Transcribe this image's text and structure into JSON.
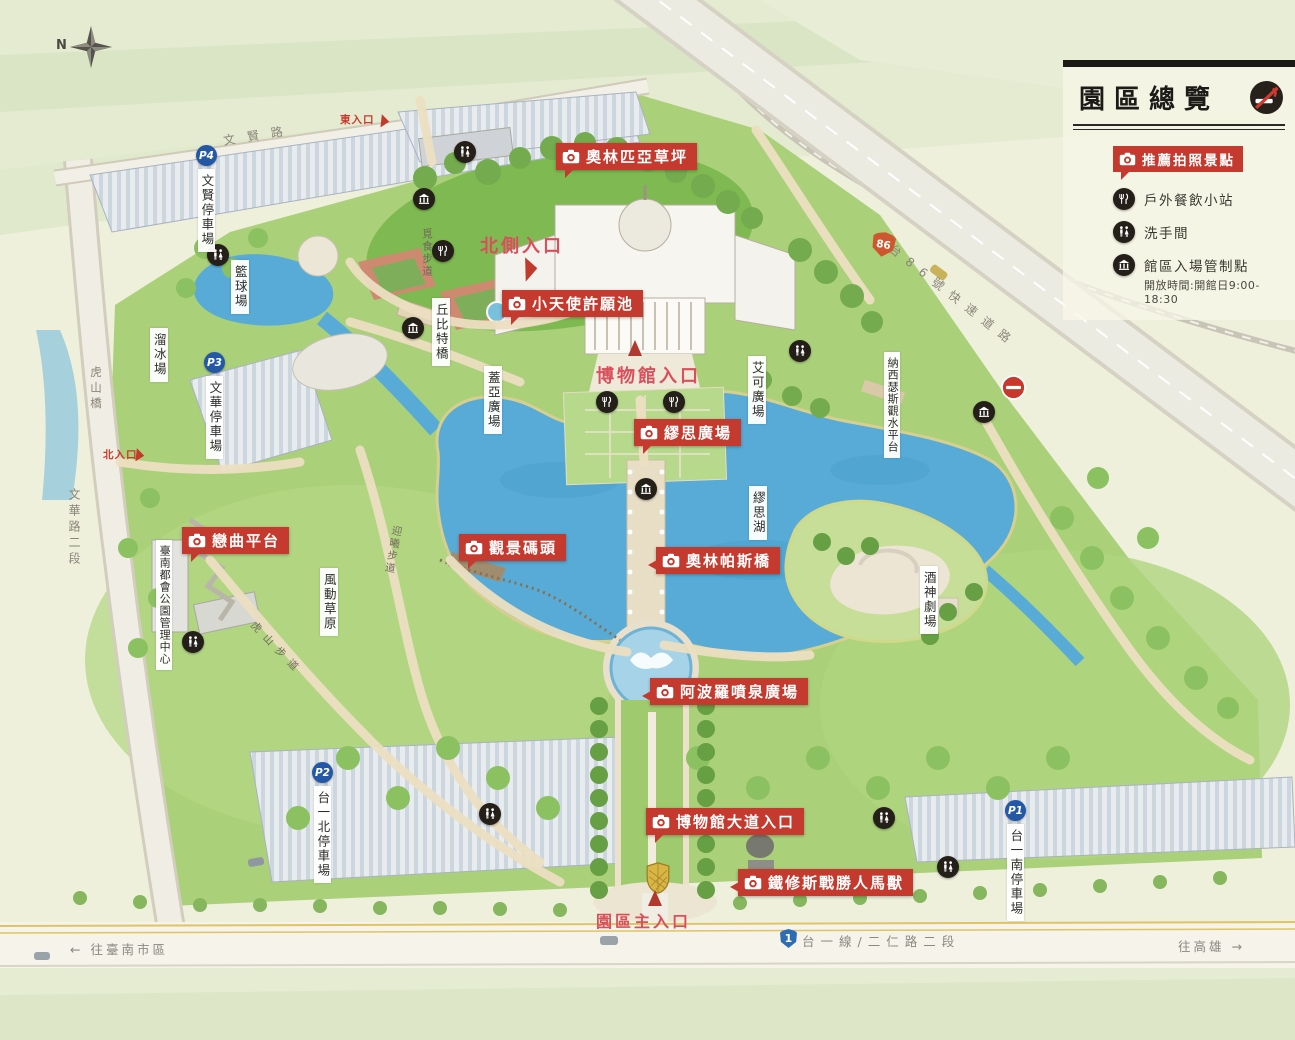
{
  "colors": {
    "badge_red": "#c43a2e",
    "entrance_pink": "#d94f5c",
    "icon_dark": "#241f19",
    "parking_blue": "#2458a6",
    "lake_blue": "#58abd6",
    "grass_green": "#a9cf78",
    "no_entry_red": "#c8382d",
    "highway_shield_orange": "#cf5730",
    "route_shield_blue": "#2e6db4",
    "crest_gold": "#d9b644"
  },
  "compass": {
    "label": "N"
  },
  "panel": {
    "title": "園區總覽",
    "legend": [
      {
        "icon": "camera-icon",
        "label": "推薦拍照景點"
      },
      {
        "icon": "dining-icon",
        "label": "戶外餐飲小站"
      },
      {
        "icon": "restroom-icon",
        "label": "洗手間"
      },
      {
        "icon": "gate-icon",
        "label": "館區入場管制點"
      }
    ],
    "hours_note": "開放時間:開館日9:00-18:30"
  },
  "photo_spots": [
    {
      "label": "奧林匹亞草坪"
    },
    {
      "label": "小天使許願池"
    },
    {
      "label": "繆思廣場"
    },
    {
      "label": "觀景碼頭"
    },
    {
      "label": "奧林帕斯橋"
    },
    {
      "label": "阿波羅噴泉廣場"
    },
    {
      "label": "博物館大道入口"
    },
    {
      "label": "鐵修斯戰勝人馬獸"
    },
    {
      "label": "戀曲平台"
    }
  ],
  "entrances": {
    "east": "東入口",
    "north_side": "北側入口",
    "museum": "博物館入口",
    "north": "北入口",
    "main": "園區主入口"
  },
  "parking": [
    {
      "badge": "P4",
      "label": "文賢停車場"
    },
    {
      "badge": "P3",
      "label": "文華停車場"
    },
    {
      "badge": "P2",
      "label": "台一北停車場"
    },
    {
      "badge": "P1",
      "label": "台一南停車場"
    }
  ],
  "places": [
    {
      "label": "籃球場"
    },
    {
      "label": "溜冰場"
    },
    {
      "label": "丘比特橋"
    },
    {
      "label": "蓋亞廣場"
    },
    {
      "label": "艾可廣場"
    },
    {
      "label": "納西瑟斯觀水平台"
    },
    {
      "label": "繆思湖"
    },
    {
      "label": "酒神劇場"
    },
    {
      "label": "風動草原"
    },
    {
      "label": "臺南都會公園管理中心"
    }
  ],
  "trails": [
    {
      "label": "覓食步道"
    },
    {
      "label": "迎曦步道"
    },
    {
      "label": "虎山步道"
    }
  ],
  "roads": {
    "wenxian": "文賢路",
    "hushan_bridge": "虎山橋",
    "wenhua": "文華路二段",
    "highway": "台86號快速道路",
    "highway_shield": "86",
    "provincial": "台一線/二仁路二段",
    "provincial_shield": "1",
    "to_tainan": "← 往臺南市區",
    "to_kaohsiung": "往高雄 →"
  }
}
